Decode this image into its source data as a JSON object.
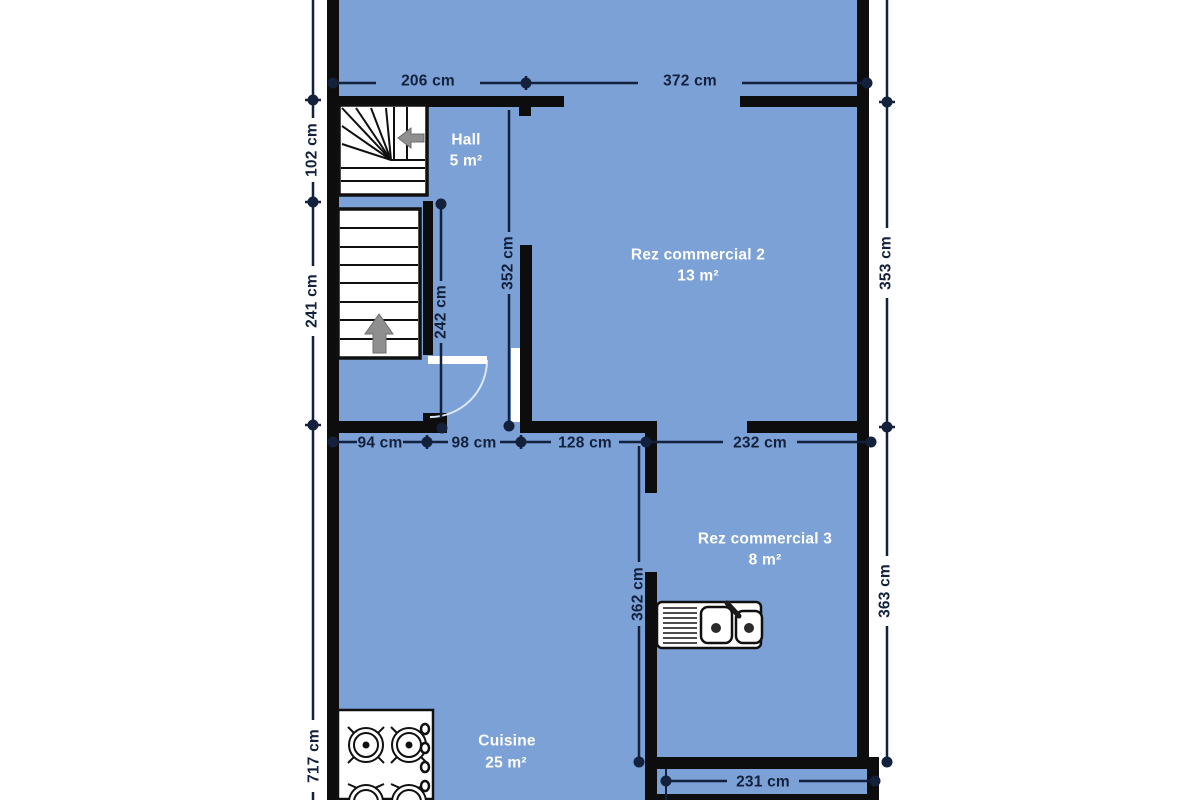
{
  "plan": {
    "type": "architectural-floor-plan",
    "units": "cm"
  },
  "colors": {
    "background": "#ffffff",
    "floor": "#7ba1d6",
    "wall": "#0d0d0d",
    "dimension": "#13213c",
    "room_label": "#ffffff",
    "fixture": "#ffffff",
    "fixture_outline": "#101010",
    "arrow": "#8f8f8f",
    "door_arc": "#dce8f7"
  },
  "rooms": [
    {
      "name": "Hall",
      "area": "5 m²"
    },
    {
      "name": "Rez commercial 2",
      "area": "13 m²"
    },
    {
      "name": "Rez commercial 3",
      "area": "8 m²"
    },
    {
      "name": "Cuisine",
      "area": "25 m²"
    }
  ],
  "dims": {
    "d206": "206 cm",
    "d372": "372 cm",
    "d102": "102 cm",
    "d241": "241 cm",
    "d717": "717 cm",
    "d353": "353 cm",
    "d363": "363 cm",
    "d94": "94 cm",
    "d98": "98 cm",
    "d128": "128 cm",
    "d232": "232 cm",
    "d231": "231 cm",
    "d242": "242 cm",
    "d352": "352 cm",
    "d362": "362 cm"
  },
  "fixtures": [
    "winder-staircase",
    "straight-staircase",
    "door-swing",
    "kitchen-sink",
    "stove"
  ]
}
